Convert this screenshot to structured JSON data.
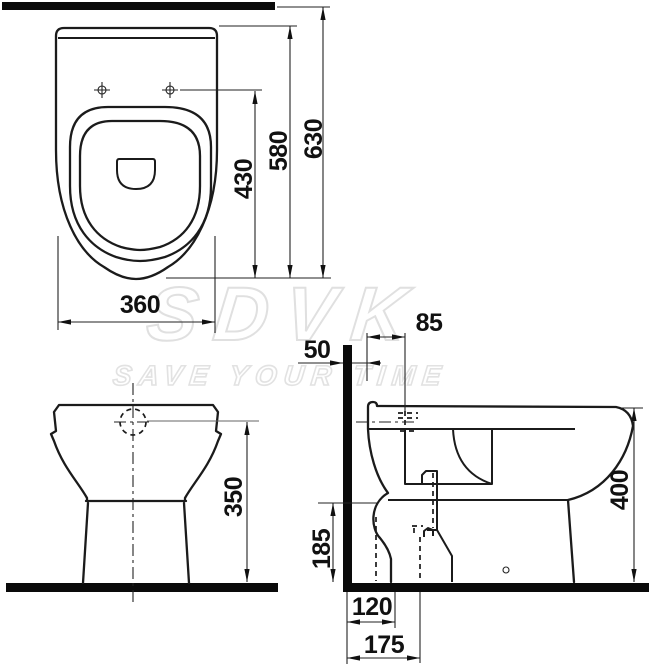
{
  "watermark": {
    "brand": "SDVK",
    "tagline": "SAVE YOUR TIME"
  },
  "dimensions": {
    "top_view": {
      "width": "360",
      "holes_to_front": "430",
      "body_depth": "580",
      "wall_to_front": "630"
    },
    "front_view": {
      "inlet_height": "350"
    },
    "side_view": {
      "wall_gap": "50",
      "hole_offset": "85",
      "rim_height": "400",
      "outlet_center_height": "185",
      "outlet_horizontal_offset": "120",
      "outlet_vertical_offset": "175"
    }
  },
  "colors": {
    "line": "#1b1b1b",
    "solid_bar": "#0a0a0a",
    "dimension_text": "#111111",
    "watermark_stroke": "#e0e0e0",
    "watermark_fill": "#ffffff",
    "background": "#ffffff"
  }
}
